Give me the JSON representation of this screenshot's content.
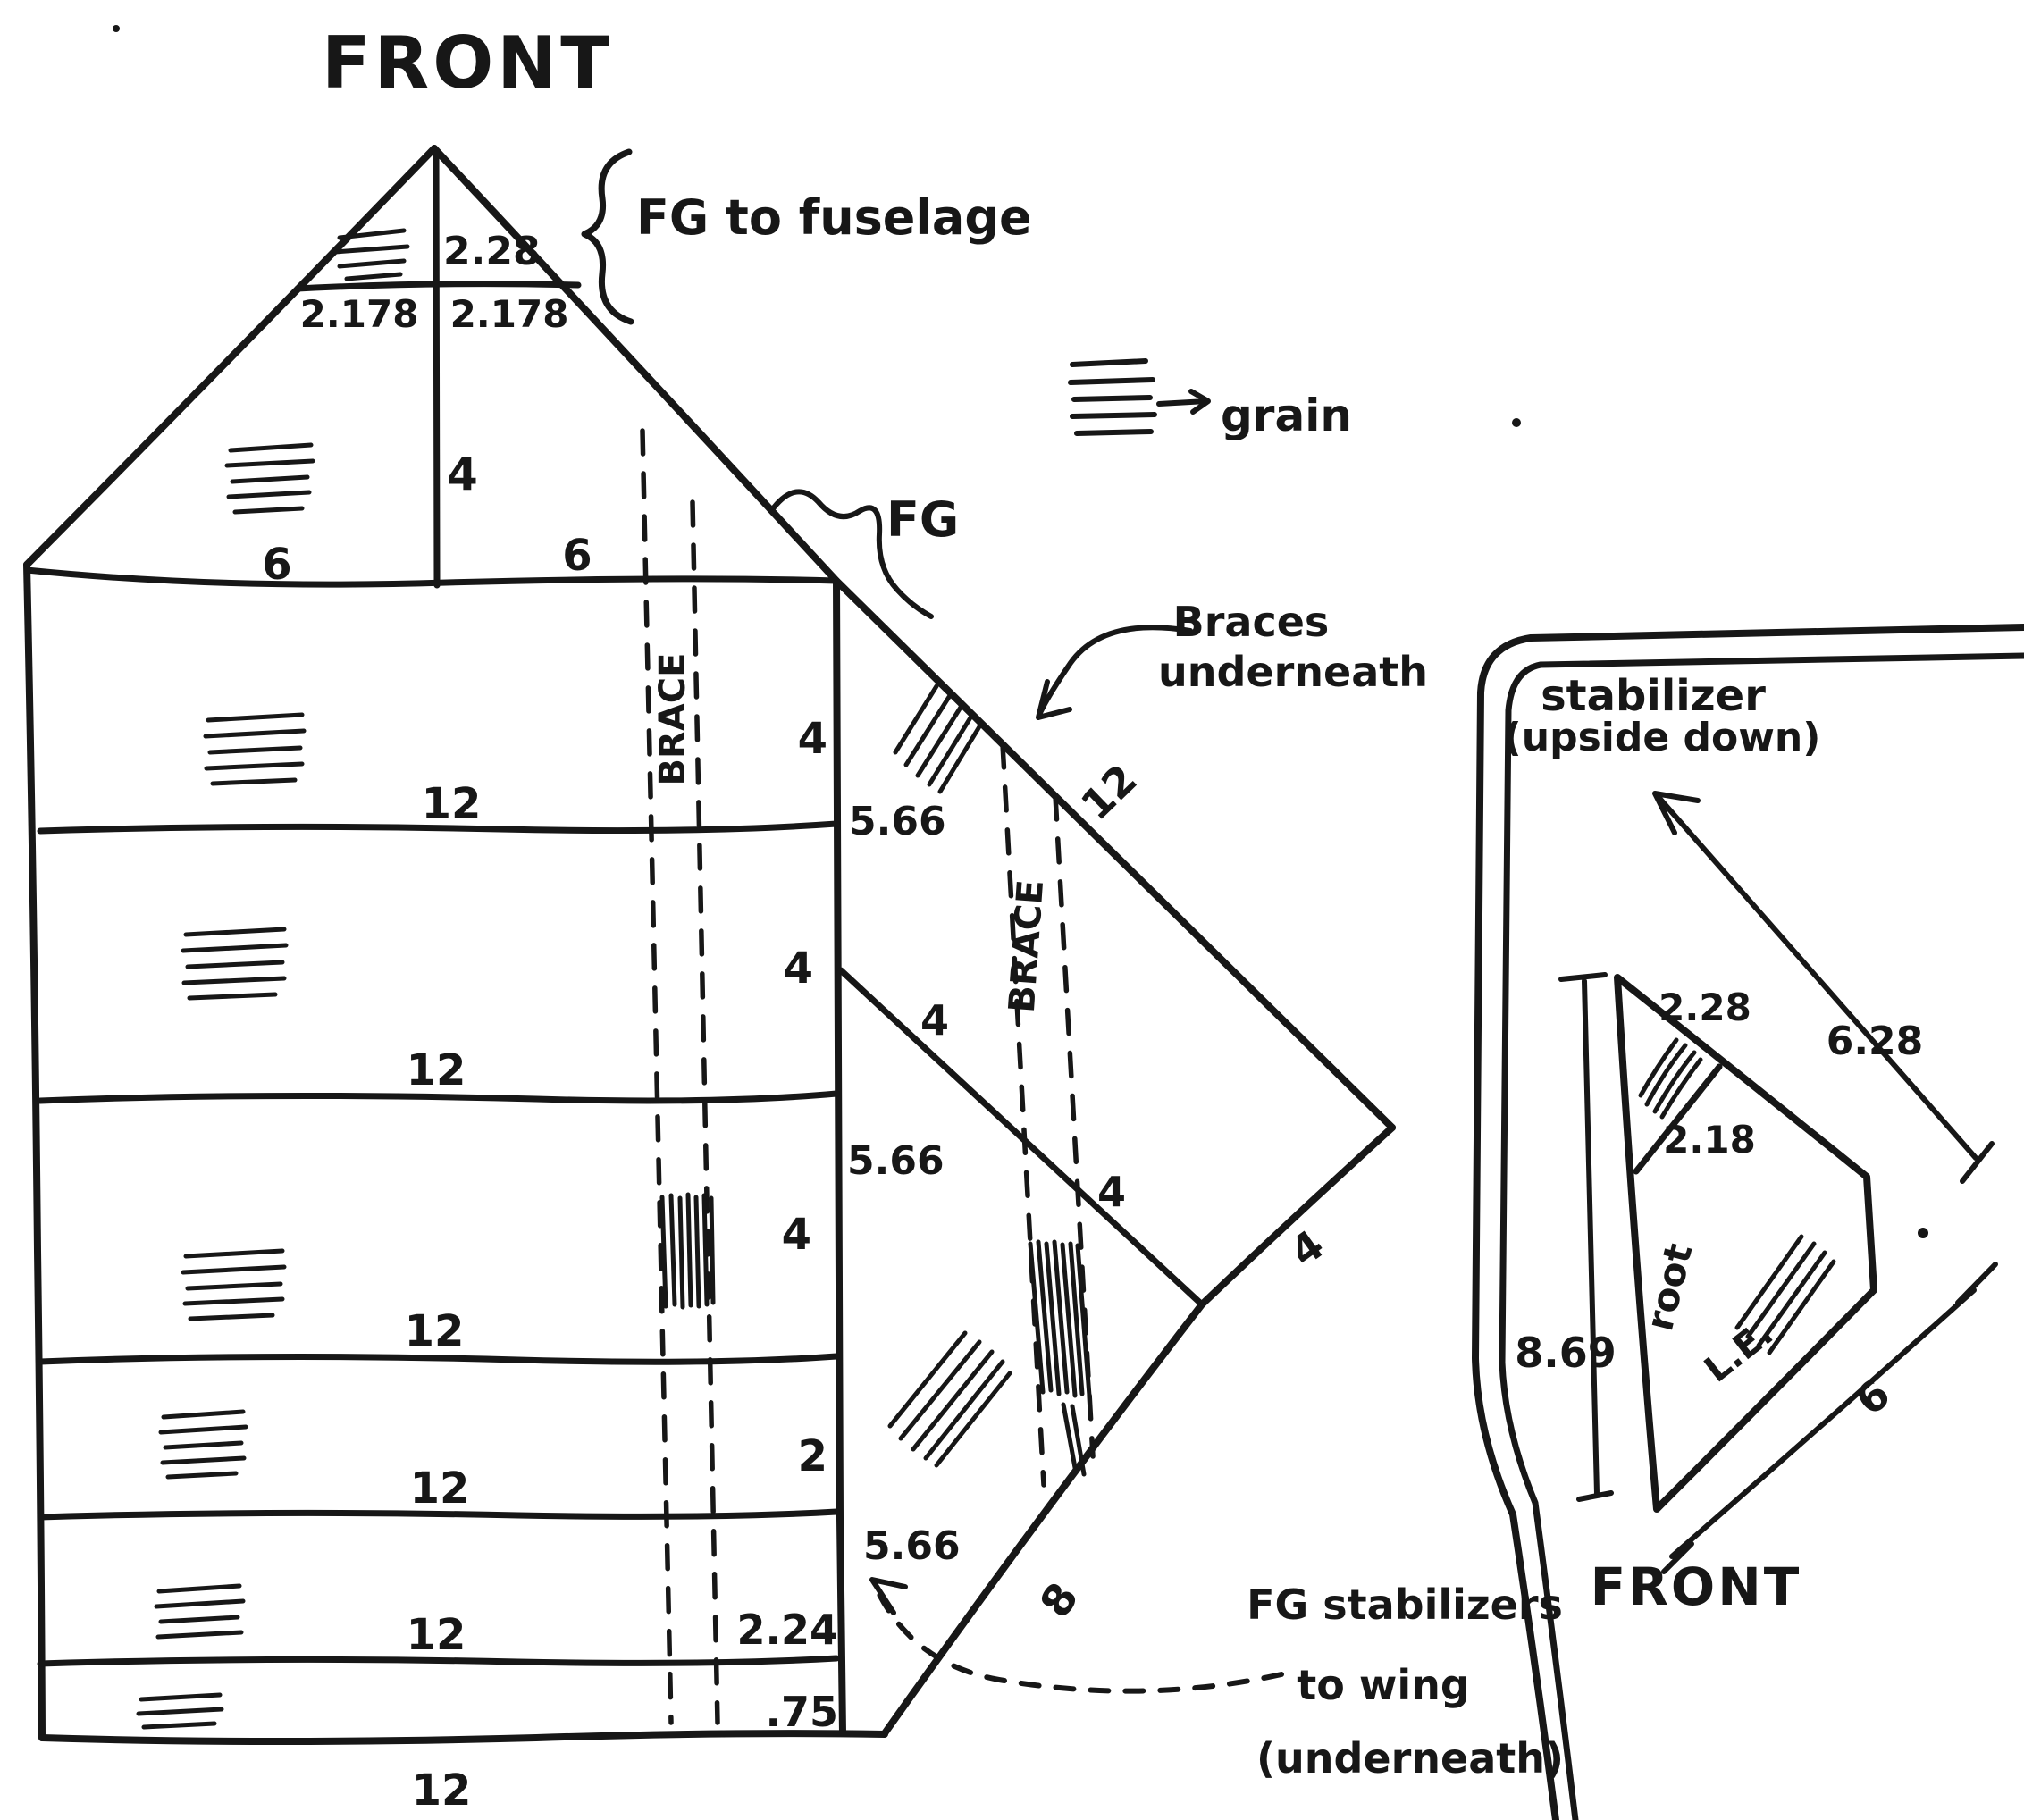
{
  "titles": {
    "front_top": "FRONT",
    "front_bottom": "FRONT"
  },
  "legend": {
    "grain_label": "grain"
  },
  "notes": {
    "fg_fuselage": "FG to fuselage",
    "fg": "FG",
    "braces_line1": "Braces",
    "braces_line2": "underneath",
    "stab_line1": "stabilizer",
    "stab_line2": "(upside down)",
    "fg_stab_line1": "FG stabilizers",
    "fg_stab_line2": "to wing",
    "fg_stab_line3": "(underneath)"
  },
  "wing_panel": {
    "triangle": {
      "apex_height": "2.28",
      "half_left": "2.178",
      "half_right": "2.178",
      "center_height": "4",
      "top_left": "6",
      "top_right": "6"
    },
    "rib_labels": [
      "12",
      "12",
      "12",
      "12",
      "12",
      "12"
    ],
    "edge_labels": [
      "4",
      "4",
      "4",
      "2",
      "2.24",
      ".75"
    ],
    "outside_labels": [
      "5.66",
      "5.66",
      "5.66"
    ],
    "brace_label": "BRACE"
  },
  "bias_section": {
    "leading_edge_label": "12",
    "brace_label": "BRACE",
    "rib_labels": [
      "4",
      "4"
    ],
    "edge_label": "4",
    "lower_edge_label": "8"
  },
  "stabilizer": {
    "tip_height": "2.28",
    "inner": "2.18",
    "top_edge": "6.28",
    "root_height": "8.69",
    "le_length": "6",
    "root_label": "root",
    "le_label": "L.E."
  }
}
